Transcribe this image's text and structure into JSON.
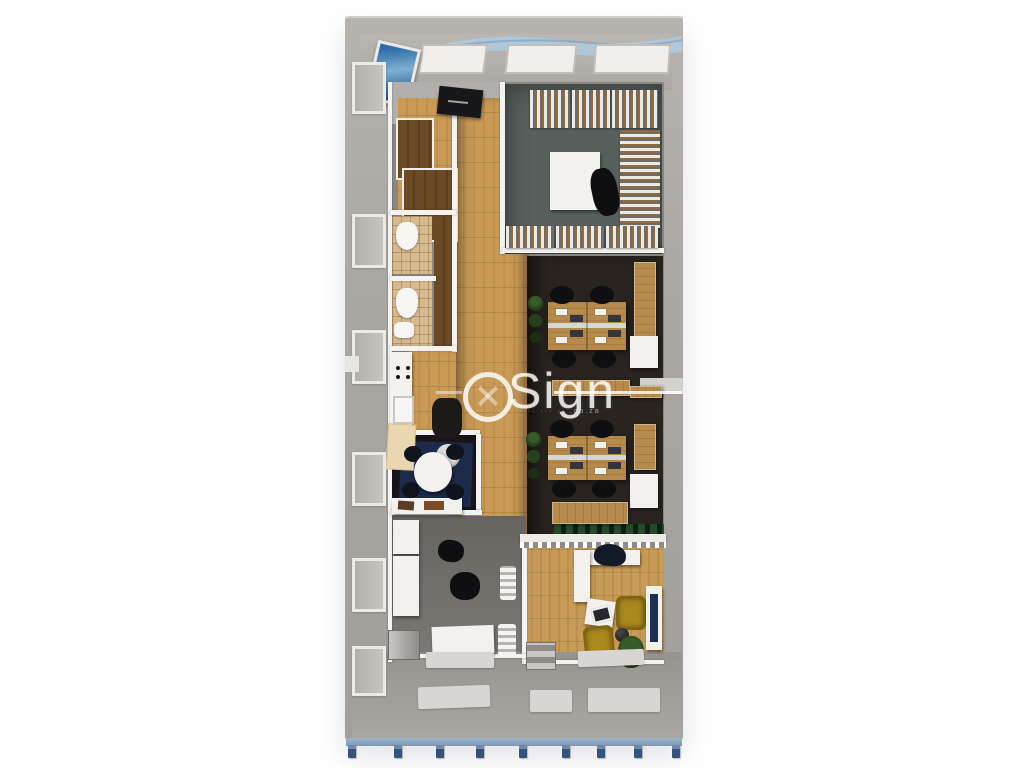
{
  "meta": {
    "type": "3d-floorplan-render",
    "description": "Top-down 3D architectural render of a narrow single-storey modular office unit standing on blue pier footings, centered on a white background"
  },
  "watermark": {
    "brand": "Sign",
    "brand_full": "OSign",
    "subtitle": "·· ··· ····· ···· ··· ·· .co.za"
  },
  "palette": {
    "background": "#ffffff",
    "exterior_wall": "#a8a4a0",
    "interior_wall": "#f4f3f1",
    "wood_floor": "#c99a55",
    "desk_wood": "#b68a4a",
    "dark_office_floor": "#2a2420",
    "storage_floor": "#57605c",
    "tile_floor": "#d6ba90",
    "closet_wood": "#6b4a26",
    "gray_floor": "#6f6d69",
    "entrance_floor": "#b2aeab",
    "apron": "#a5a19d",
    "accent_chair": "#a9881c",
    "base_blue": "#8aa3bd",
    "pier_blue": "#35517c",
    "wave_blue": "#aecadd",
    "navy_rug": "#1d2a4a",
    "plant_green": "#27421e"
  },
  "scene": {
    "view": "top-down dollhouse view",
    "structure": "container-style office block with blue chassis and nine footing piers",
    "rooms": [
      {
        "name": "entrance-lobby",
        "floor": "gray",
        "furniture": [
          "wall picture",
          "reception sign",
          "ceiling camera box"
        ]
      },
      {
        "name": "storage-room",
        "floor": "dark gray",
        "furniture": [
          "slatted shelving racks on three walls",
          "white square table",
          "black chair"
        ]
      },
      {
        "name": "corridor",
        "floor": "light oak planks"
      },
      {
        "name": "wardrobe-closets",
        "floor": "dark wood",
        "furniture": [
          "white framed closets"
        ]
      },
      {
        "name": "wc-1",
        "floor": "beige tile",
        "furniture": [
          "toilet"
        ]
      },
      {
        "name": "wc-2",
        "floor": "beige tile",
        "furniture": [
          "toilet",
          "basin"
        ]
      },
      {
        "name": "kitchenette",
        "floor": "oak planks",
        "furniture": [
          "counter with hob",
          "sink",
          "cream cabinet",
          "coffee machine"
        ]
      },
      {
        "name": "meeting-nook",
        "floor": "dark with navy rug",
        "furniture": [
          "round white table",
          "four dark chairs"
        ]
      },
      {
        "name": "open-office-upper",
        "floor": "dark brown",
        "furniture": [
          "4-seat wooden desk cluster",
          "monitors",
          "keyboards",
          "plant",
          "wall credenza",
          "white cabinet"
        ]
      },
      {
        "name": "open-office-lower",
        "floor": "dark brown",
        "furniture": [
          "4-seat wooden desk cluster",
          "monitors",
          "keyboards",
          "plant",
          "wall credenza",
          "white cabinet",
          "sideboards"
        ]
      },
      {
        "name": "small-office",
        "floor": "gray",
        "furniture": [
          "white desk",
          "dark chairs",
          "tall white cabinet",
          "metal mini fridge",
          "console table",
          "floor mats"
        ]
      },
      {
        "name": "manager-office",
        "floor": "oak planks",
        "furniture": [
          "L-shaped white desk",
          "navy desk chair",
          "coffee table with tablet",
          "two mustard armchairs",
          "potted plant",
          "side sphere table",
          "wall screen",
          "step stool",
          "glass partition with planter"
        ]
      }
    ]
  }
}
